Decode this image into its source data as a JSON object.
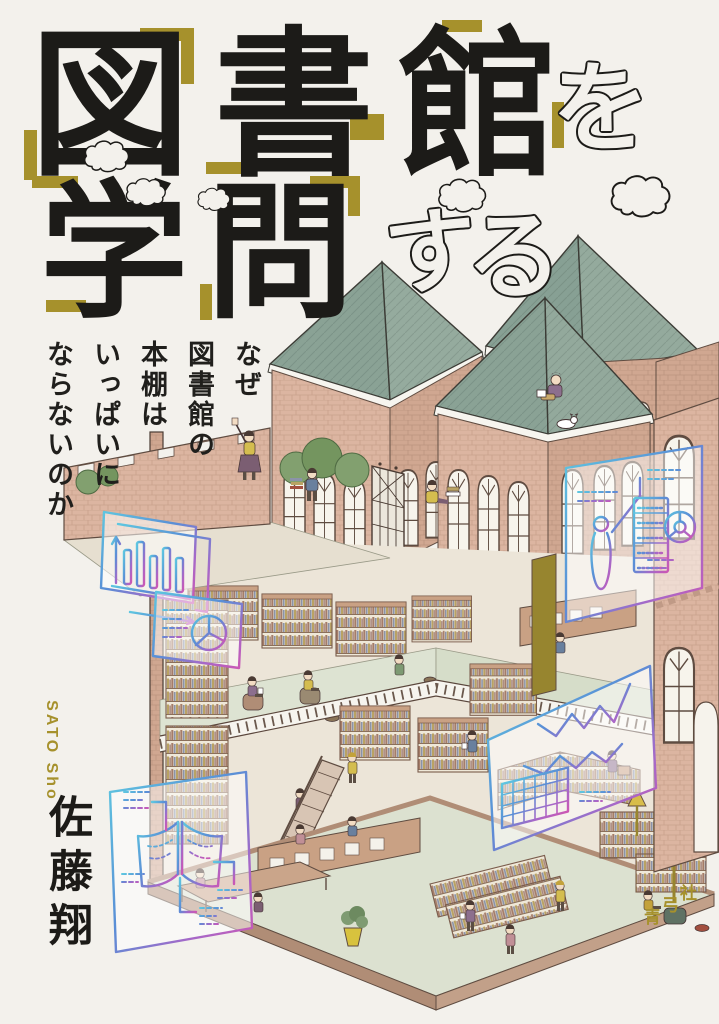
{
  "cover": {
    "title": {
      "line1": "図書館",
      "line1_chars": [
        "図",
        "書",
        "館"
      ],
      "particle": "を",
      "line2": "学問",
      "line2_chars": [
        "学",
        "問"
      ],
      "suffix": "する",
      "suffix_chars": [
        "す",
        "る"
      ]
    },
    "subtitle": {
      "full": "なぜ図書館の本棚はいっぱいにならないのか",
      "lines": [
        "なぜ",
        "図書館の",
        "本棚は",
        "いっぱいに",
        "ならないのか"
      ]
    },
    "author": {
      "romanized": "SATO Sho",
      "name": "佐藤翔"
    },
    "publisher": {
      "name": "青弓社",
      "chars": [
        "青",
        "弓",
        "社"
      ]
    },
    "colors": {
      "background": "#f3f1ec",
      "ink": "#1c1b18",
      "accent_gold": "#a6912c",
      "roof_green": "#8ca29a",
      "brick": "#dcb5a1",
      "floor_green": "#dde3d2",
      "neon_cyan": "#5ec7e0",
      "neon_blue": "#5a8ed6",
      "neon_purple": "#9b6cc9",
      "neon_magenta": "#cc57b4"
    },
    "illustration": {
      "overlay_icons": [
        "bar-chart-icon",
        "pie-chart-icon",
        "person-figure-icon",
        "bookshelf-icon",
        "donut-chart-icon",
        "line-chart-icon",
        "table-grid-icon",
        "open-book-icon",
        "cloud-icon"
      ]
    }
  }
}
